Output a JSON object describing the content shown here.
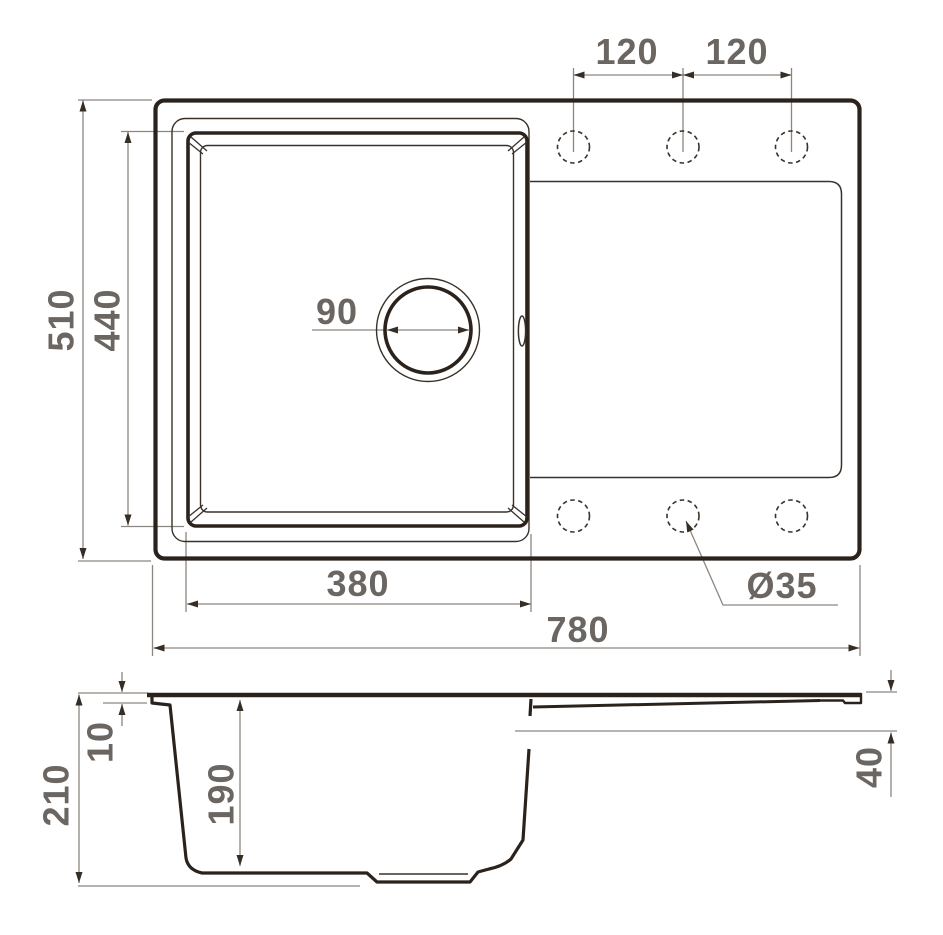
{
  "meta": {
    "title": "Kitchen sink dimensional drawing"
  },
  "colors": {
    "line": "#2b221c",
    "dim_line": "#8c8680",
    "text": "#6b6661",
    "background": "#ffffff"
  },
  "top_view": {
    "width_label": "780",
    "depth_label": "510",
    "bowl_width_label": "380",
    "bowl_depth_label": "440",
    "drain_diameter_label": "90",
    "tap_spacing_left_label": "120",
    "tap_spacing_right_label": "120",
    "tap_hole_diameter_label": "Ø35"
  },
  "section_view": {
    "height_label": "210",
    "rim_height_label": "10",
    "bowl_depth_label": "190",
    "drainboard_depth_label": "40"
  }
}
